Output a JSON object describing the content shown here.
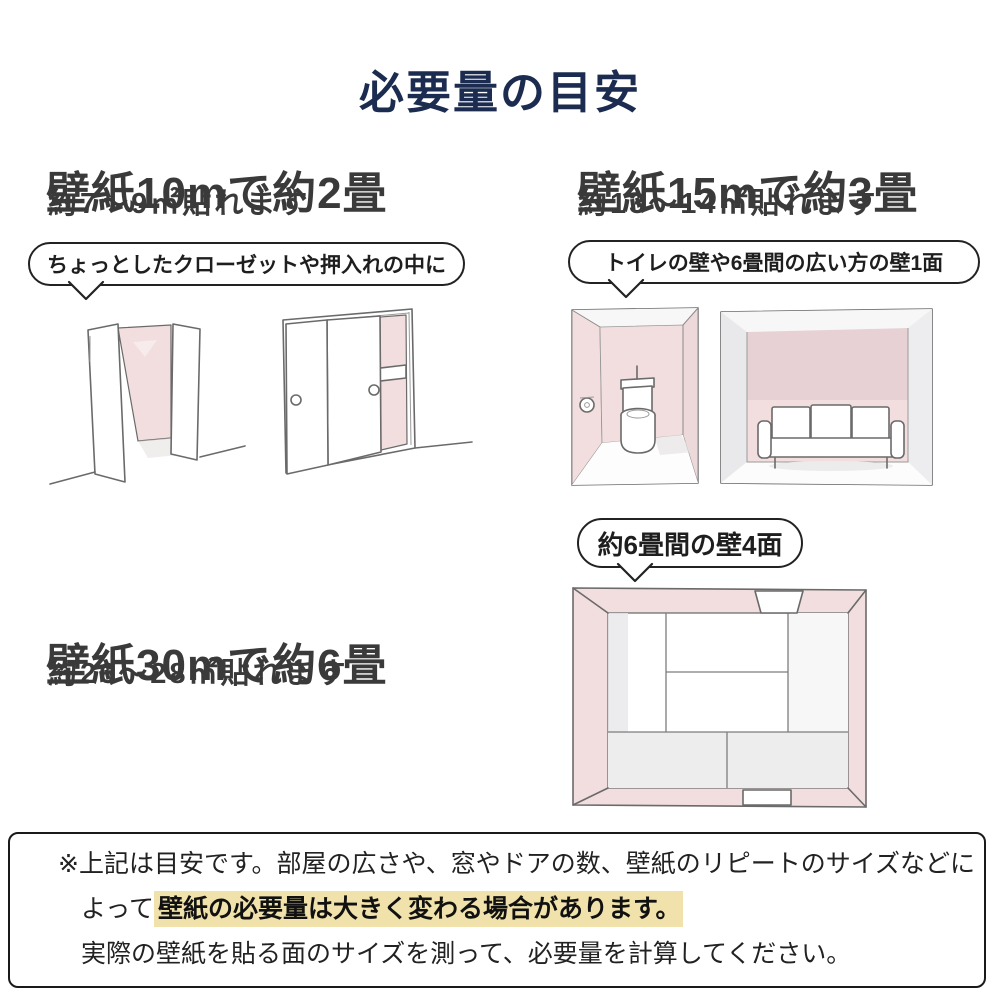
{
  "title": {
    "text": "必要量の目安"
  },
  "sections": {
    "s10": {
      "heading": "壁紙10mで約2畳",
      "sub": "約7〜9㎡貼れます",
      "bubble": "ちょっとしたクローゼットや押入れの中に"
    },
    "s15": {
      "heading": "壁紙15mで約3畳",
      "sub": "約13〜14㎡貼れます",
      "bubble": "トイレの壁や6畳間の広い方の壁1面"
    },
    "s30": {
      "heading": "壁紙30mで約6畳",
      "sub": "約26〜28㎡貼れます",
      "bubble": "約6畳間の壁4面"
    }
  },
  "note": {
    "line1": "※上記は目安です。部屋の広さや、窓やドアの数、壁紙のリピートのサイズなどに",
    "line2_prefix": "よって",
    "line2_highlight": "壁紙の必要量は大きく変わる場合があります。",
    "line3": "実際の壁紙を貼る面のサイズを測って、必要量を計算してください。"
  },
  "icons": {
    "closet_open": "open-closet-illustration",
    "closet_sliding": "sliding-door-closet-illustration",
    "toilet_room": "toilet-room-illustration",
    "living_room": "living-room-sofa-illustration",
    "tatami_room": "six-tatami-room-top-view-illustration",
    "bubble_tail": "speech-bubble-tail"
  },
  "colors": {
    "title_navy": "#1b2c50",
    "heading_gray": "#3a3a3a",
    "outline_black": "#222222",
    "sketch_line": "#6a6a6a",
    "wall_pink": "#f2dede",
    "wall_pink_dark": "#e7d1d5",
    "wall_gray": "#e9e9eb",
    "floor_gray": "#ededee",
    "highlight_yellow": "#f0e2aa"
  }
}
